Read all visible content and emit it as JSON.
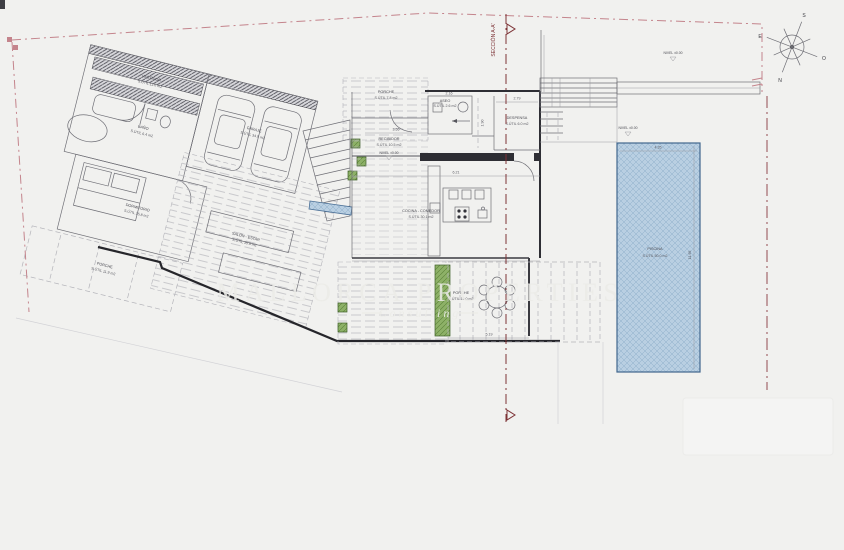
{
  "plan": {
    "watermark": {
      "title": "MALLORCA PROPERTIES",
      "subtitle": "Consulting"
    },
    "section_label": "SECCIÓN A-A'",
    "compass": {
      "n": "N",
      "s": "S",
      "e": "E",
      "o": "O"
    },
    "levels": {
      "entry": "NIVEL ±0.00",
      "terrace": "NIVEL ±0.00",
      "pool": "NIVEL ±0.00"
    },
    "rooms": {
      "vestidor": {
        "name": "VESTIDOR",
        "area": "S.ÚTIL 11.0 m2"
      },
      "bano": {
        "name": "BAÑO",
        "area": "S.ÚTIL 6.4 m2"
      },
      "garaje": {
        "name": "GARAJE",
        "area": "S.ÚTIL 34.9 m2"
      },
      "dormitorio": {
        "name": "DORMITORIO",
        "area": "S.ÚTIL 15.8 m2"
      },
      "porche_oeste": {
        "name": "PORCHE",
        "area": "S.ÚTIL 11.9 m2"
      },
      "salon": {
        "name": "SALÓN - ESTAR",
        "area": "S.ÚTIL 35.9 m2"
      },
      "porche_entrada": {
        "name": "PORCHE",
        "area": "S.ÚTIL 7.8 m2"
      },
      "recibidor": {
        "name": "RECIBIDOR",
        "area": "S.ÚTIL 10.5 m2"
      },
      "aseo": {
        "name": "ASEO",
        "area": "S.ÚTIL 2.6 m2"
      },
      "despensa": {
        "name": "DESPENSA",
        "area": "S.ÚTIL 6.0 m2"
      },
      "cocina": {
        "name": "COCINA - COMEDOR",
        "area": "S.ÚTIL 30.1 m2"
      },
      "porche_comedor": {
        "name": "PORCHE",
        "area": "S.ÚTIL 19.0 m2"
      },
      "piscina": {
        "name": "PISCINA",
        "area": "S.ÚTIL 50.0 m2"
      }
    },
    "dims": {
      "aseo": "2.16",
      "despensa": "2.79",
      "recibidor": "3.55",
      "salon_comedor": "6.21",
      "pasillo": "1.90",
      "porche": "5.19",
      "pool_width": "4.35",
      "pool_length": "11.95"
    },
    "colors": {
      "pool": "#b9cfe2",
      "garden": "#8db167",
      "boundary": "#c4848c",
      "section": "#7d3336"
    }
  }
}
